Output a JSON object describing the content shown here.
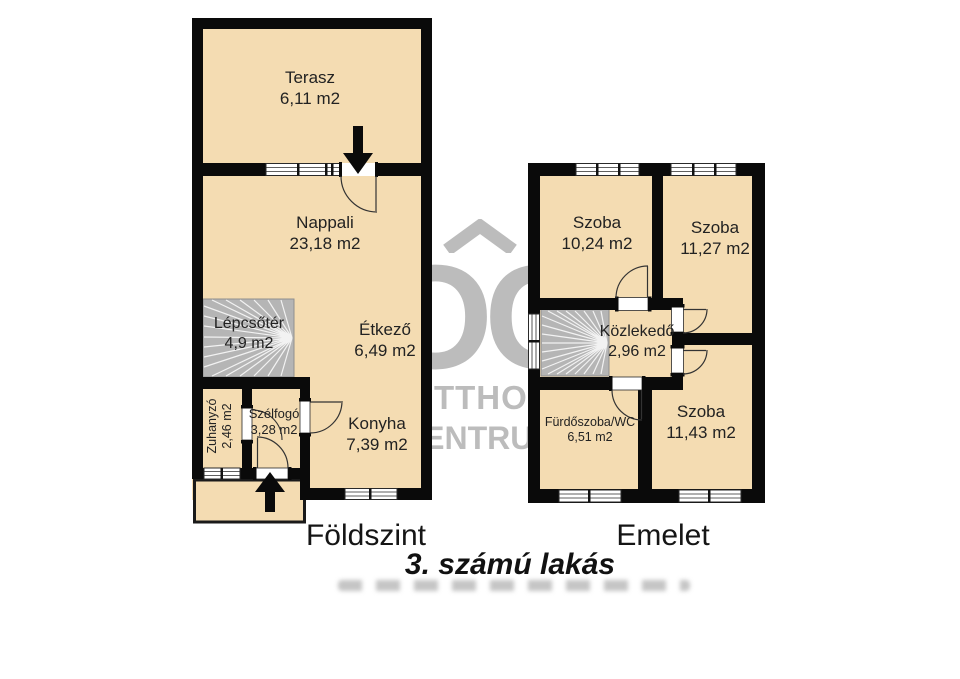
{
  "title": "3. számú lakás",
  "watermark": {
    "initials": "OC",
    "line1": "OTTHON",
    "line2": "CENTRUM"
  },
  "floors": {
    "ground": {
      "caption": "Földszint",
      "rooms": {
        "terasz": {
          "name": "Terasz",
          "area": "6,11 m2"
        },
        "nappali": {
          "name": "Nappali",
          "area": "23,18 m2"
        },
        "lepcsoter": {
          "name": "Lépcsőtér",
          "area": "4,9 m2"
        },
        "etkezo": {
          "name": "Étkező",
          "area": "6,49 m2"
        },
        "zuhanyzo": {
          "name": "Zuhanyzó",
          "area": "2,46 m2"
        },
        "szelfogo": {
          "name": "Szélfogó",
          "area": "3,28 m2"
        },
        "konyha": {
          "name": "Konyha",
          "area": "7,39 m2"
        }
      }
    },
    "upper": {
      "caption": "Emelet",
      "rooms": {
        "szoba1": {
          "name": "Szoba",
          "area": "10,24 m2"
        },
        "szoba2": {
          "name": "Szoba",
          "area": "11,27 m2"
        },
        "kozlekedo": {
          "name": "Közlekedő",
          "area": "2,96 m2"
        },
        "furdoszoba": {
          "name": "Fürdőszoba/WC",
          "area": "6,51 m2"
        },
        "szoba3": {
          "name": "Szoba",
          "area": "11,43 m2"
        }
      }
    }
  },
  "colors": {
    "room_fill": "#f4dcb2",
    "wall": "#0a0a0a",
    "stair_fill": "#b5b5b5",
    "watermark_gray": "#bcbcbc"
  }
}
